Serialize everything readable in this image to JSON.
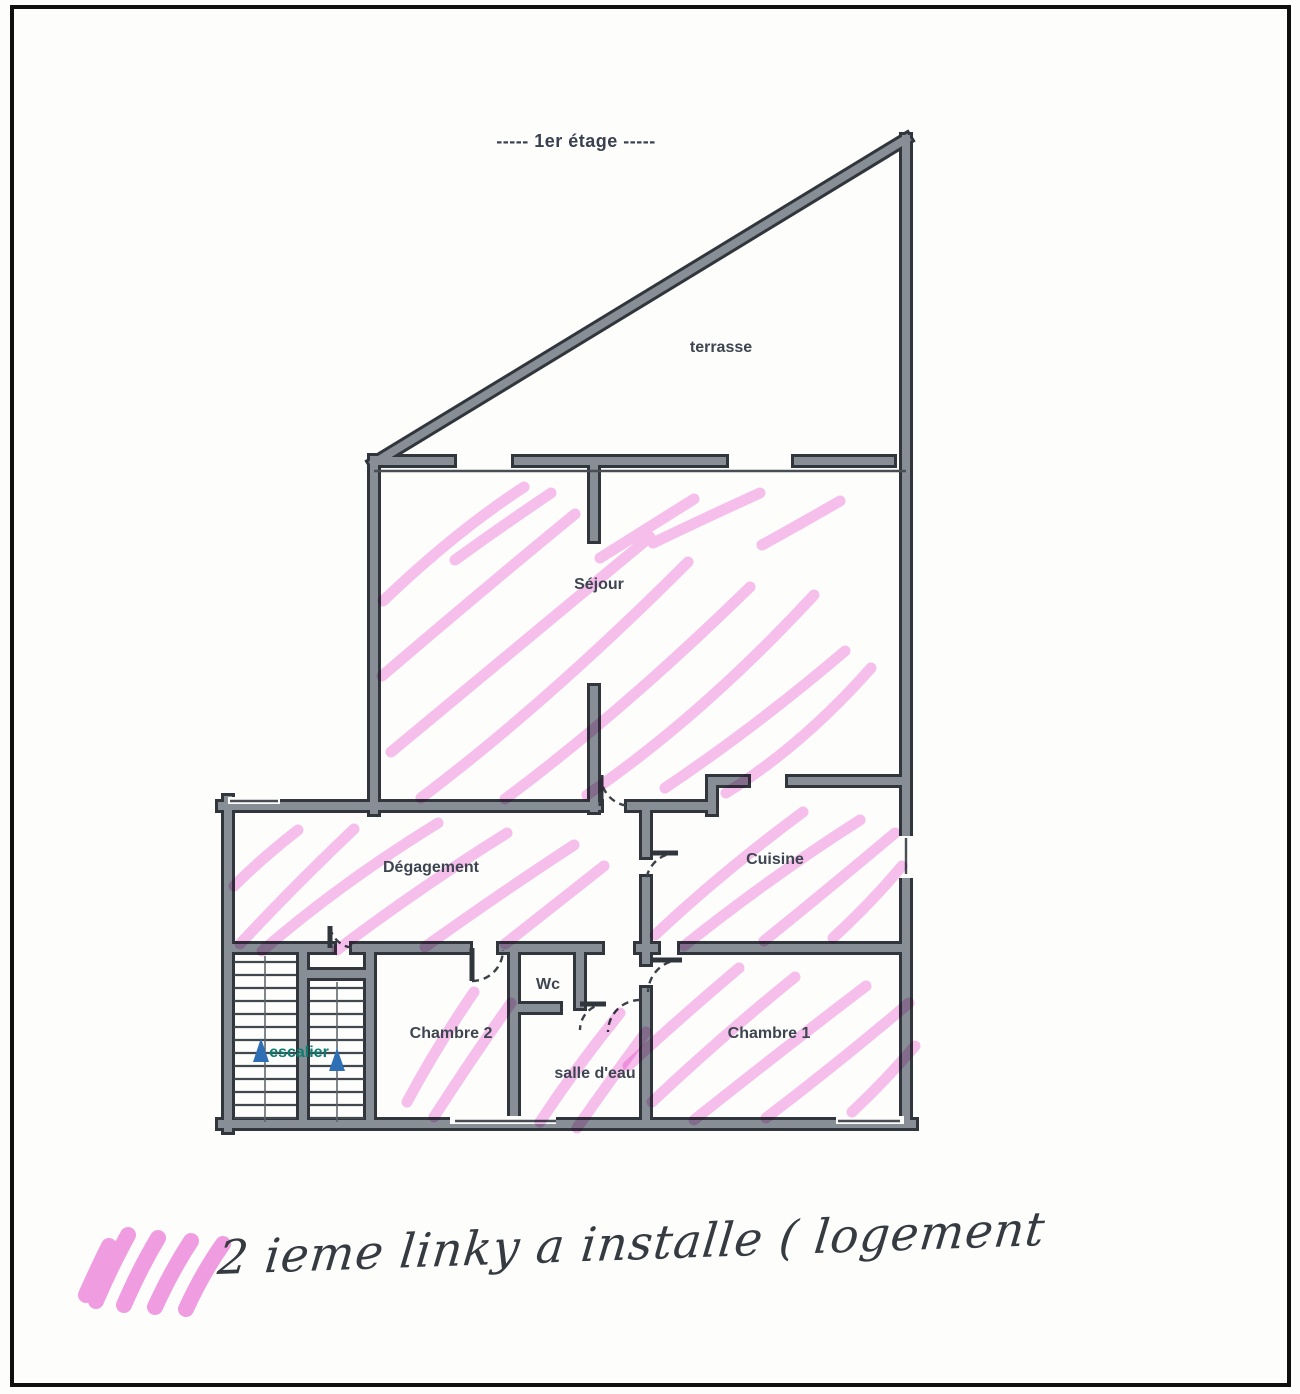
{
  "page": {
    "title": "----- 1er étage -----"
  },
  "rooms": [
    {
      "id": "terrasse",
      "label": "terrasse"
    },
    {
      "id": "sejour",
      "label": "Séjour"
    },
    {
      "id": "degagement",
      "label": "Dégagement"
    },
    {
      "id": "cuisine",
      "label": "Cuisine"
    },
    {
      "id": "wc",
      "label": "Wc"
    },
    {
      "id": "chambre2",
      "label": "Chambre 2"
    },
    {
      "id": "salle_deau",
      "label": "salle d'eau"
    },
    {
      "id": "chambre1",
      "label": "Chambre 1"
    },
    {
      "id": "escalier",
      "label": "escalier"
    }
  ],
  "stairs": {
    "arrow_icon": "stairs-up-arrow-icon",
    "arrow_count": 2
  },
  "annotation": {
    "note": "2 ieme linky a installe ( logement",
    "highlighted_rooms": [
      "Séjour",
      "Dégagement",
      "Cuisine",
      "Chambre 1",
      "Chambre 2",
      "salle d'eau"
    ]
  },
  "colors": {
    "highlighter": "#ef85de",
    "wall_fill": "#878e96",
    "wall_edge": "#31363c",
    "room_label": "#3e4550",
    "escalier_label": "#0d7c6f",
    "stairs_arrow": "#2e6fb5",
    "pen": "#363b41",
    "page_border": "#101010"
  }
}
